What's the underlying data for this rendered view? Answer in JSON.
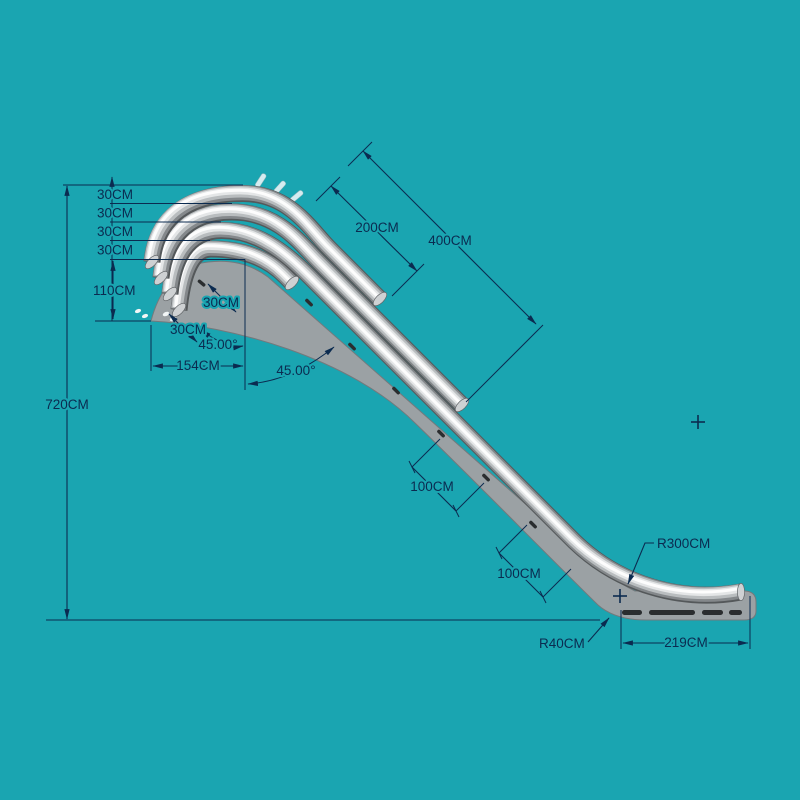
{
  "app": {
    "description": "CAD technical drawing of water-slide profile",
    "background_color": "#1AA5B1",
    "line_color": "#0B2B50",
    "board_color": "#9BA1A4",
    "tube_highlight": "#FDFDFD",
    "tube_shadow": "#54585A",
    "unit": "CM"
  },
  "dimensions": {
    "stack_30cm": [
      "30CM",
      "30CM",
      "30CM",
      "30CM"
    ],
    "height_110": "110CM",
    "total_height": "720CM",
    "base_width": "154CM",
    "angle_left": "45.00°",
    "diag_spacing": [
      "30CM",
      "30CM"
    ],
    "angle_slope": "45.00°",
    "len_200": "200CM",
    "len_400": "400CM",
    "len_100_upper": "100CM",
    "len_100_lower": "100CM",
    "radius_large": "R300CM",
    "radius_small": "R40CM",
    "runout": "219CM"
  }
}
